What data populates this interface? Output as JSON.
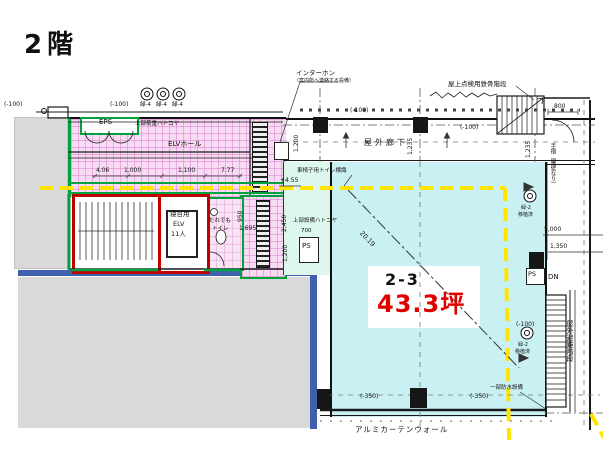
{
  "title": "2階",
  "unit": {
    "code": "2-3",
    "area": "43.3坪"
  },
  "labels": {
    "eps": "EPS",
    "elv_hall": "ELVホール",
    "upper_load_hatch": "上部荷重ハトコヤ",
    "stretcher_l1": "寝台用",
    "stretcher_l2": "ELV",
    "stretcher_l3": "11人",
    "toilet_l1": "だれでも",
    "toilet_l2": "トイレ",
    "outdoor_corridor": "屋外廊下",
    "upper_equip_hatch": "上部設備ハトコヤ",
    "ps": "PS",
    "dn": "DN",
    "intercom_l1": "インターホン",
    "intercom_l2": "（案内所へ連絡する設備）",
    "roof_stair": "屋上点検用鉄骨階段",
    "wheelchair_sign": "車椅子用トイレ標識",
    "level_455": "+4.55",
    "escape_stair": "屋外避難階段",
    "handrail_note": "手摺（腰壁なり）",
    "waterproof_note": "一部防水設備",
    "curtain_wall": "アルミカーテンウォール",
    "green4": "緑-4",
    "green2": "緑-2",
    "transplant": "移植済",
    "lv_m100": "(-100)",
    "lv_m350": "(-350)"
  },
  "dims": {
    "d800": "800",
    "d1235": "1,235",
    "d5000": "5,000",
    "d1350": "1,350",
    "d2450": "2,450",
    "d1200": "1,200",
    "d700": "700",
    "d950": "950",
    "d1695": "1,695",
    "d406": "4.06",
    "d1000": "1,000",
    "d1100": "1,100",
    "d777": "7.77",
    "d2019": "20.19"
  },
  "colors": {
    "area_text_red": "#e00000",
    "zone_cyan": "#c9f1f3",
    "zone_pink": "#f6dbf2",
    "zone_mint": "#def7ec",
    "line_yellow": "#ffe400",
    "line_green": "#00a33f",
    "room_border_red": "#c00000",
    "mass_blue": "#3f61ad",
    "mass_gray": "#d9d9d9"
  }
}
